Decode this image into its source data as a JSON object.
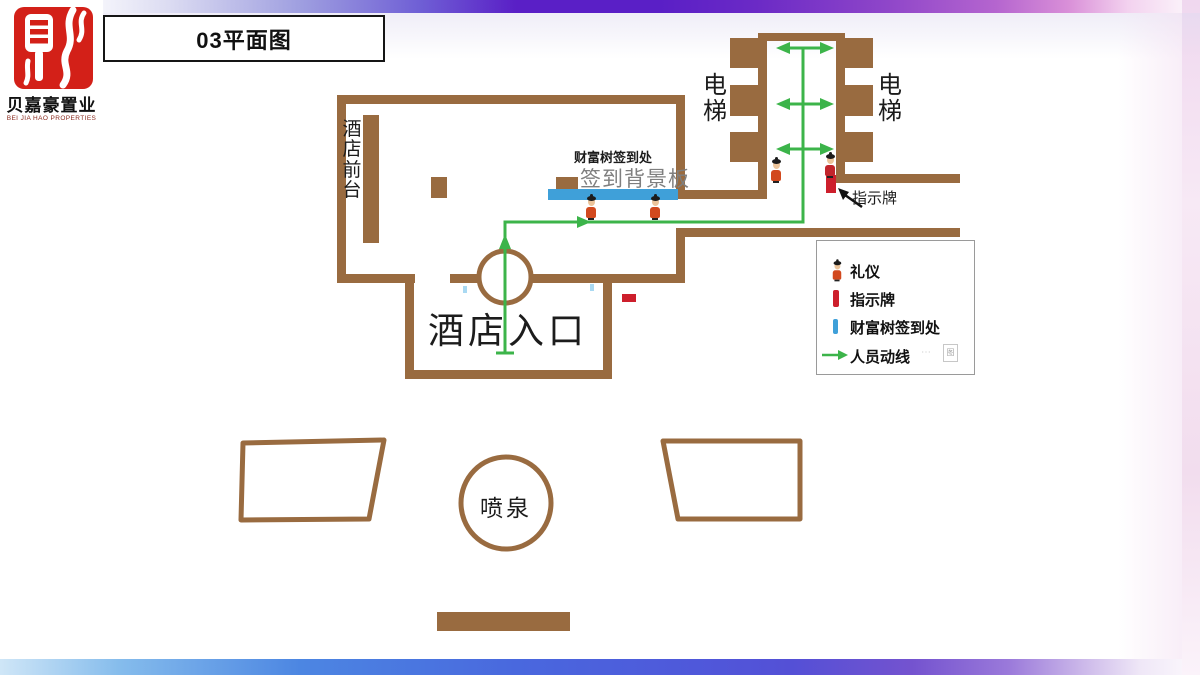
{
  "brand": {
    "company_cn": "贝嘉豪置业",
    "company_en": "BEI JIA HAO PROPERTIES",
    "seal_icon": "red-seal-cai-icon"
  },
  "header": {
    "title": "03平面图"
  },
  "plan": {
    "labels": {
      "front_desk": "酒店前台",
      "checkin_label": "财富树签到处",
      "checkin_board": "签到背景板",
      "elevator_left": "电梯",
      "elevator_right": "电梯",
      "sign_pointer": "指示牌",
      "entrance": "酒店入口",
      "fountain": "喷泉"
    },
    "colors": {
      "wall_brown": "#996b40",
      "flow_green": "#3cb44a",
      "board_blue": "#3fa0d9",
      "sign_red": "#cd1f2c"
    },
    "icons": [
      "greeter-figure-icon",
      "flow-arrow-icon",
      "double-arrow-icon",
      "pointer-arrow-icon"
    ]
  },
  "legend": {
    "items": [
      {
        "label": "礼仪",
        "icon": "greeter-figure-icon"
      },
      {
        "label": "指示牌",
        "icon": "sign-bar-icon",
        "color": "#cd1f2c"
      },
      {
        "label": "财富树签到处",
        "icon": "board-bar-icon",
        "color": "#3fa0d9"
      },
      {
        "label": "人员动线",
        "icon": "flow-arrow-icon",
        "color": "#3cb44a"
      }
    ],
    "watermark_glyph": "图"
  }
}
